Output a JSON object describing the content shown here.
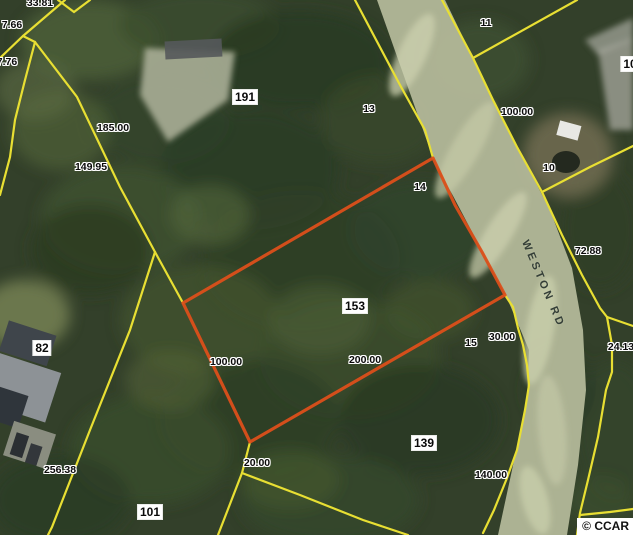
{
  "map": {
    "copyright": "© CCAR",
    "road_label": {
      "text": "WESTON RD",
      "x": 543,
      "y": 284,
      "rotation": 67
    },
    "colors": {
      "forest": "#33402a",
      "parcel_line": "#e8df33",
      "highlight_parcel": "#dc4f1a",
      "road": "#b3b899"
    },
    "highlighted_parcel": {
      "number": "153",
      "edge_labels": [
        "100.00",
        "200.00",
        "20.00",
        "14"
      ]
    },
    "labels": [
      {
        "text": "33.81",
        "x": 40,
        "y": 3,
        "type": "halo"
      },
      {
        "text": "7.66",
        "x": 12,
        "y": 25,
        "type": "halo"
      },
      {
        "text": "7.76",
        "x": 7,
        "y": 62,
        "type": "halo"
      },
      {
        "text": "185.00",
        "x": 113,
        "y": 128,
        "type": "halo"
      },
      {
        "text": "149.95",
        "x": 91,
        "y": 167,
        "type": "halo"
      },
      {
        "text": "191",
        "x": 245,
        "y": 97,
        "type": "box"
      },
      {
        "text": "13",
        "x": 369,
        "y": 109,
        "type": "halo"
      },
      {
        "text": "11",
        "x": 486,
        "y": 23,
        "type": "halo"
      },
      {
        "text": "10",
        "x": 630,
        "y": 64,
        "type": "box"
      },
      {
        "text": "100.00",
        "x": 517,
        "y": 112,
        "type": "halo"
      },
      {
        "text": "10",
        "x": 549,
        "y": 168,
        "type": "halo"
      },
      {
        "text": "14",
        "x": 420,
        "y": 187,
        "type": "halo"
      },
      {
        "text": "72.88",
        "x": 588,
        "y": 251,
        "type": "halo"
      },
      {
        "text": "153",
        "x": 355,
        "y": 306,
        "type": "box"
      },
      {
        "text": "24.13",
        "x": 621,
        "y": 347,
        "type": "halo"
      },
      {
        "text": "30.00",
        "x": 502,
        "y": 337,
        "type": "halo"
      },
      {
        "text": "15",
        "x": 471,
        "y": 343,
        "type": "halo"
      },
      {
        "text": "82",
        "x": 42,
        "y": 348,
        "type": "box"
      },
      {
        "text": "100.00",
        "x": 226,
        "y": 362,
        "type": "halo"
      },
      {
        "text": "200.00",
        "x": 365,
        "y": 360,
        "type": "halo"
      },
      {
        "text": "139",
        "x": 424,
        "y": 443,
        "type": "box"
      },
      {
        "text": "20.00",
        "x": 257,
        "y": 463,
        "type": "halo"
      },
      {
        "text": "256.38",
        "x": 60,
        "y": 470,
        "type": "halo"
      },
      {
        "text": "140.00",
        "x": 491,
        "y": 475,
        "type": "halo"
      },
      {
        "text": "101",
        "x": 150,
        "y": 512,
        "type": "box"
      }
    ]
  }
}
